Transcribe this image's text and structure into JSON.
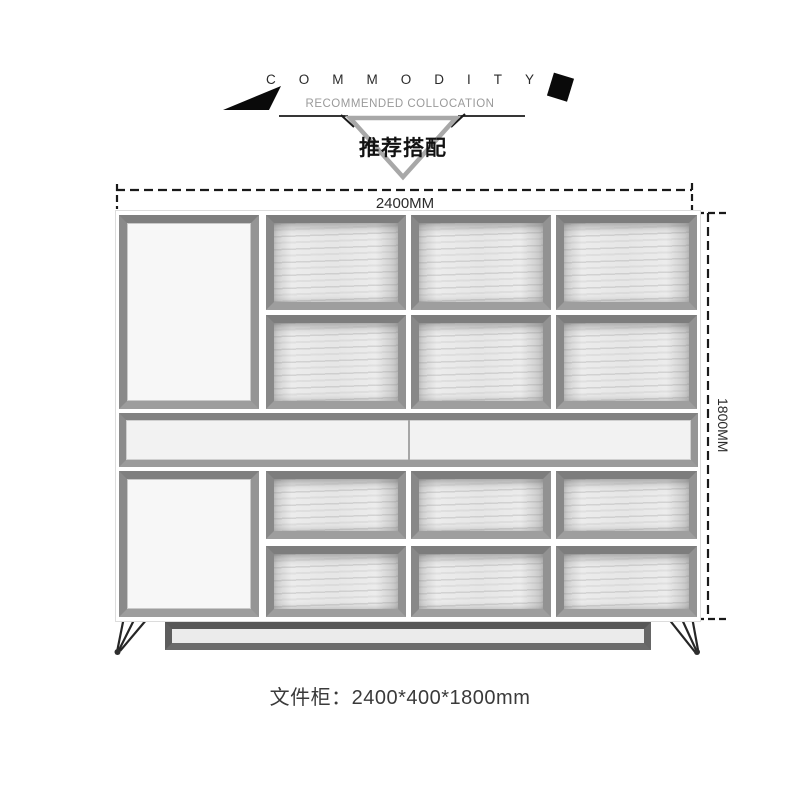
{
  "header": {
    "title": "COMMODITY",
    "subtitle": "RECOMMENDED COLLOCATION",
    "badge": "推荐搭配"
  },
  "dimension_labels": {
    "width": "2400MM",
    "height": "1800MM"
  },
  "product": {
    "name": "文件柜",
    "size": "2400*400*1800mm",
    "caption": "文件柜：2400*400*1800mm"
  },
  "icons": {
    "left_flag": "black-flag-icon",
    "right_diamond": "black-diamond-icon",
    "ribbon": "down-triangle-ribbon"
  },
  "colors": {
    "frame_gray": "#8d8d8d",
    "base_dark": "#5c5c5c",
    "ribbon_gray": "#a8a8a8",
    "dimension_line": "#1a1a1a",
    "subtitle_gray": "#9a9a9a",
    "caption_text": "#3a3a3a"
  }
}
